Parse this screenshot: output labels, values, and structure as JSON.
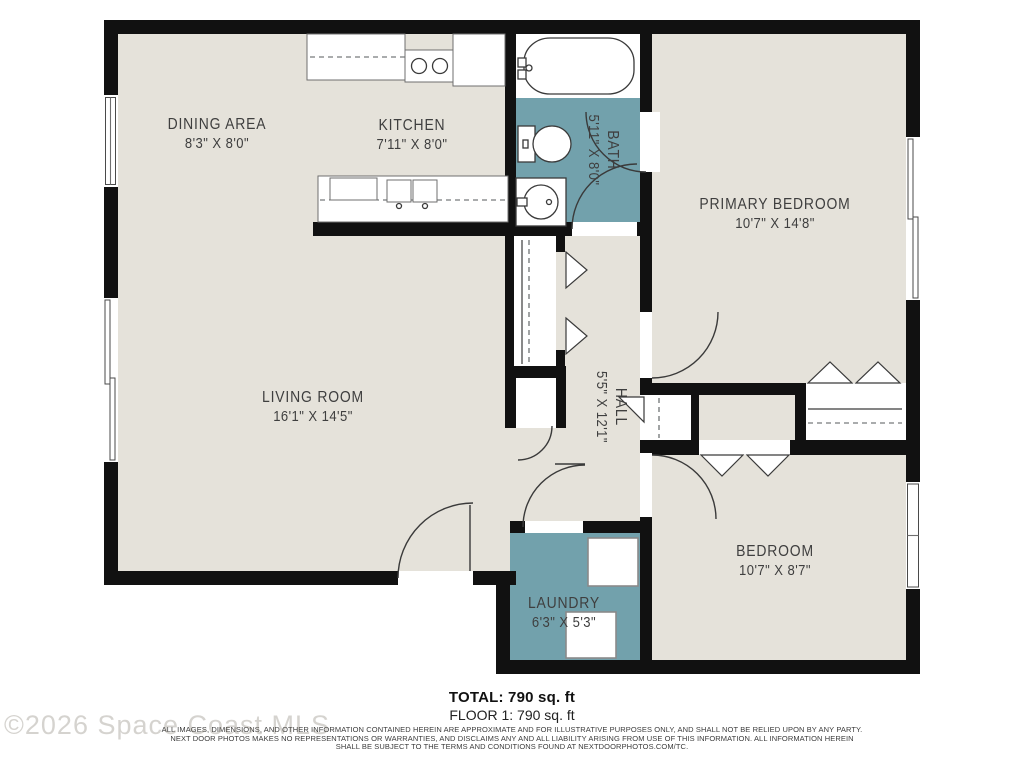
{
  "colors": {
    "wall": "#111111",
    "floor": "#e5e2da",
    "wet_floor": "#72a1ac",
    "fixture_stroke": "#3a3a3a",
    "label_text": "#3f3f3f"
  },
  "rooms": [
    {
      "name": "DINING AREA",
      "dims": "8'3\" X 8'0\""
    },
    {
      "name": "KITCHEN",
      "dims": "7'11\" X 8'0\""
    },
    {
      "name": "BATH",
      "dims": "5'11\" X 8'0\""
    },
    {
      "name": "PRIMARY BEDROOM",
      "dims": "10'7\" X 14'8\""
    },
    {
      "name": "LIVING ROOM",
      "dims": "16'1\" X 14'5\""
    },
    {
      "name": "HALL",
      "dims": "5'5\" X 12'1\""
    },
    {
      "name": "BEDROOM",
      "dims": "10'7\" X 8'7\""
    },
    {
      "name": "LAUNDRY",
      "dims": "6'3\" X 5'3\""
    }
  ],
  "footer": {
    "total": "TOTAL: 790 sq. ft",
    "floor": "FLOOR 1: 790 sq. ft",
    "disclaimer_lines": [
      "ALL IMAGES, DIMENSIONS, AND OTHER INFORMATION CONTAINED HEREIN ARE APPROXIMATE AND FOR ILLUSTRATIVE PURPOSES ONLY, AND SHALL NOT BE RELIED UPON BY ANY PARTY.",
      "NEXT DOOR PHOTOS MAKES NO REPRESENTATIONS OR WARRANTIES, AND DISCLAIMS ANY AND ALL LIABILITY ARISING FROM USE OF THIS INFORMATION. ALL INFORMATION HEREIN",
      "SHALL BE SUBJECT TO THE TERMS AND CONDITIONS FOUND AT NEXTDOORPHOTOS.COM/TC."
    ]
  },
  "watermark": "©2026 Space Coast MLS"
}
